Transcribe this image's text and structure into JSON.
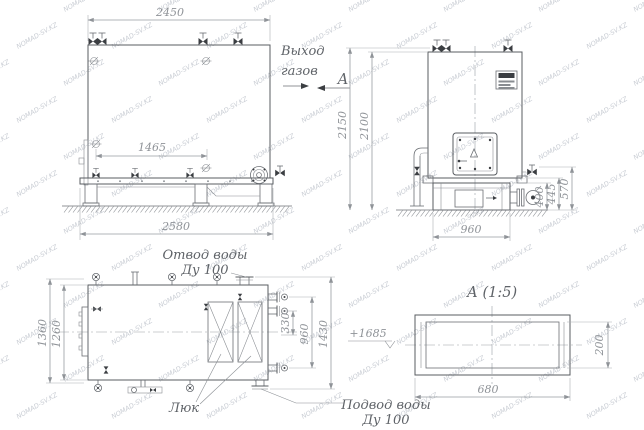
{
  "labels": {
    "gas_outlet": {
      "line1": "Выход",
      "line2": "газов"
    },
    "section_arrow": "А",
    "detail_title": "А  (1:5)",
    "water_outlet": {
      "line1": "Отвод воды",
      "line2": "Ду 100"
    },
    "water_inlet": {
      "line1": "Подвод воды",
      "line2": "Ду 100"
    },
    "hatch": "Люк",
    "elevation": "+1685"
  },
  "dimensions": {
    "side_view": {
      "top_width": "2450",
      "valve_span": "1465",
      "base_width": "2580"
    },
    "front_view": {
      "overall_height": "2150",
      "body_height": "2100",
      "base_height": "400",
      "base_height_mid": "445",
      "base_height_top": "570",
      "base_width": "960"
    },
    "plan_view": {
      "overall_width": "1360",
      "body_width": "1260",
      "nozzle_offset": "330",
      "nozzle_span": "960",
      "overall_length": "1430"
    },
    "detail_a": {
      "width": "680",
      "height": "200"
    }
  },
  "watermark": {
    "text": "NOMAD-SV.KZ"
  }
}
